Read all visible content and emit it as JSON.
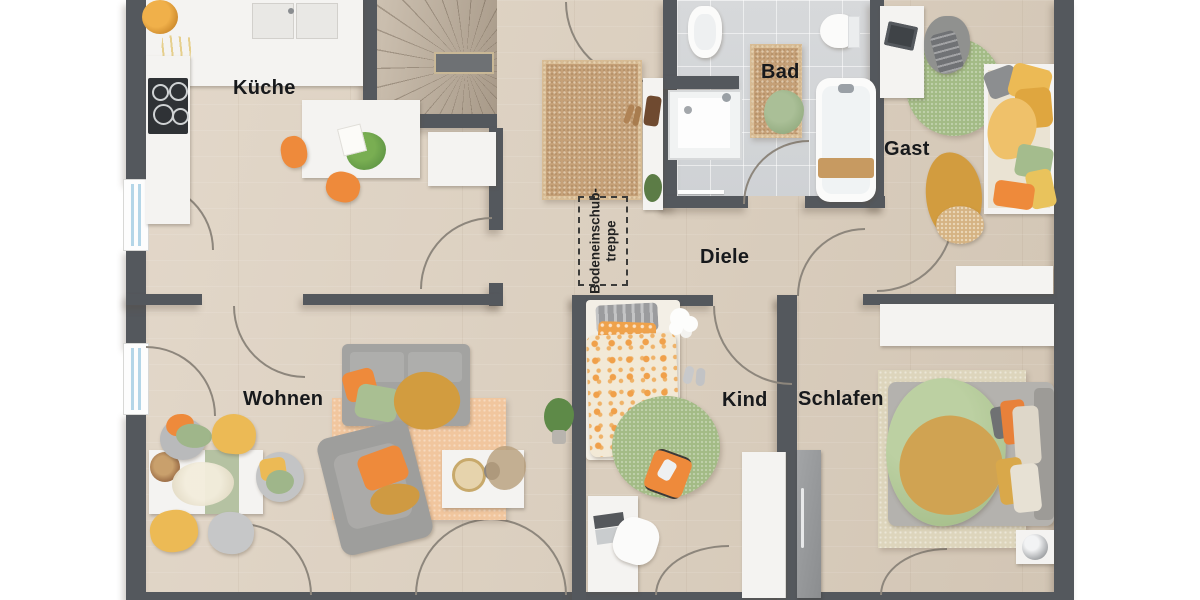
{
  "rooms": {
    "kueche": {
      "label": "Küche"
    },
    "bad": {
      "label": "Bad"
    },
    "gast": {
      "label": "Gast"
    },
    "diele": {
      "label": "Diele"
    },
    "wohnen": {
      "label": "Wohnen"
    },
    "kind": {
      "label": "Kind"
    },
    "schlafen": {
      "label": "Schlafen"
    }
  },
  "annotations": {
    "attic_ladder": {
      "line1": "Bodeneinschub-",
      "line2": "treppe"
    }
  },
  "colors": {
    "wall": "#54585d",
    "arc": "#8d867c",
    "furn_white": "#f4f3f1",
    "window_glass": "#b4d6e8",
    "rug_jute": "#c5a077",
    "rug_green": "#a3bb86",
    "rug_peach": "#f1c69e",
    "rug_beige": "#ddd5bc",
    "sofa_gray": "#a3a3a1",
    "chair_gray": "#c3c4c5",
    "accent_orange": "#ee8a3b",
    "accent_yellow": "#ecba55",
    "accent_mustard": "#d29c3f",
    "accent_green": "#a4bc8d",
    "label_color": "#17191c"
  }
}
